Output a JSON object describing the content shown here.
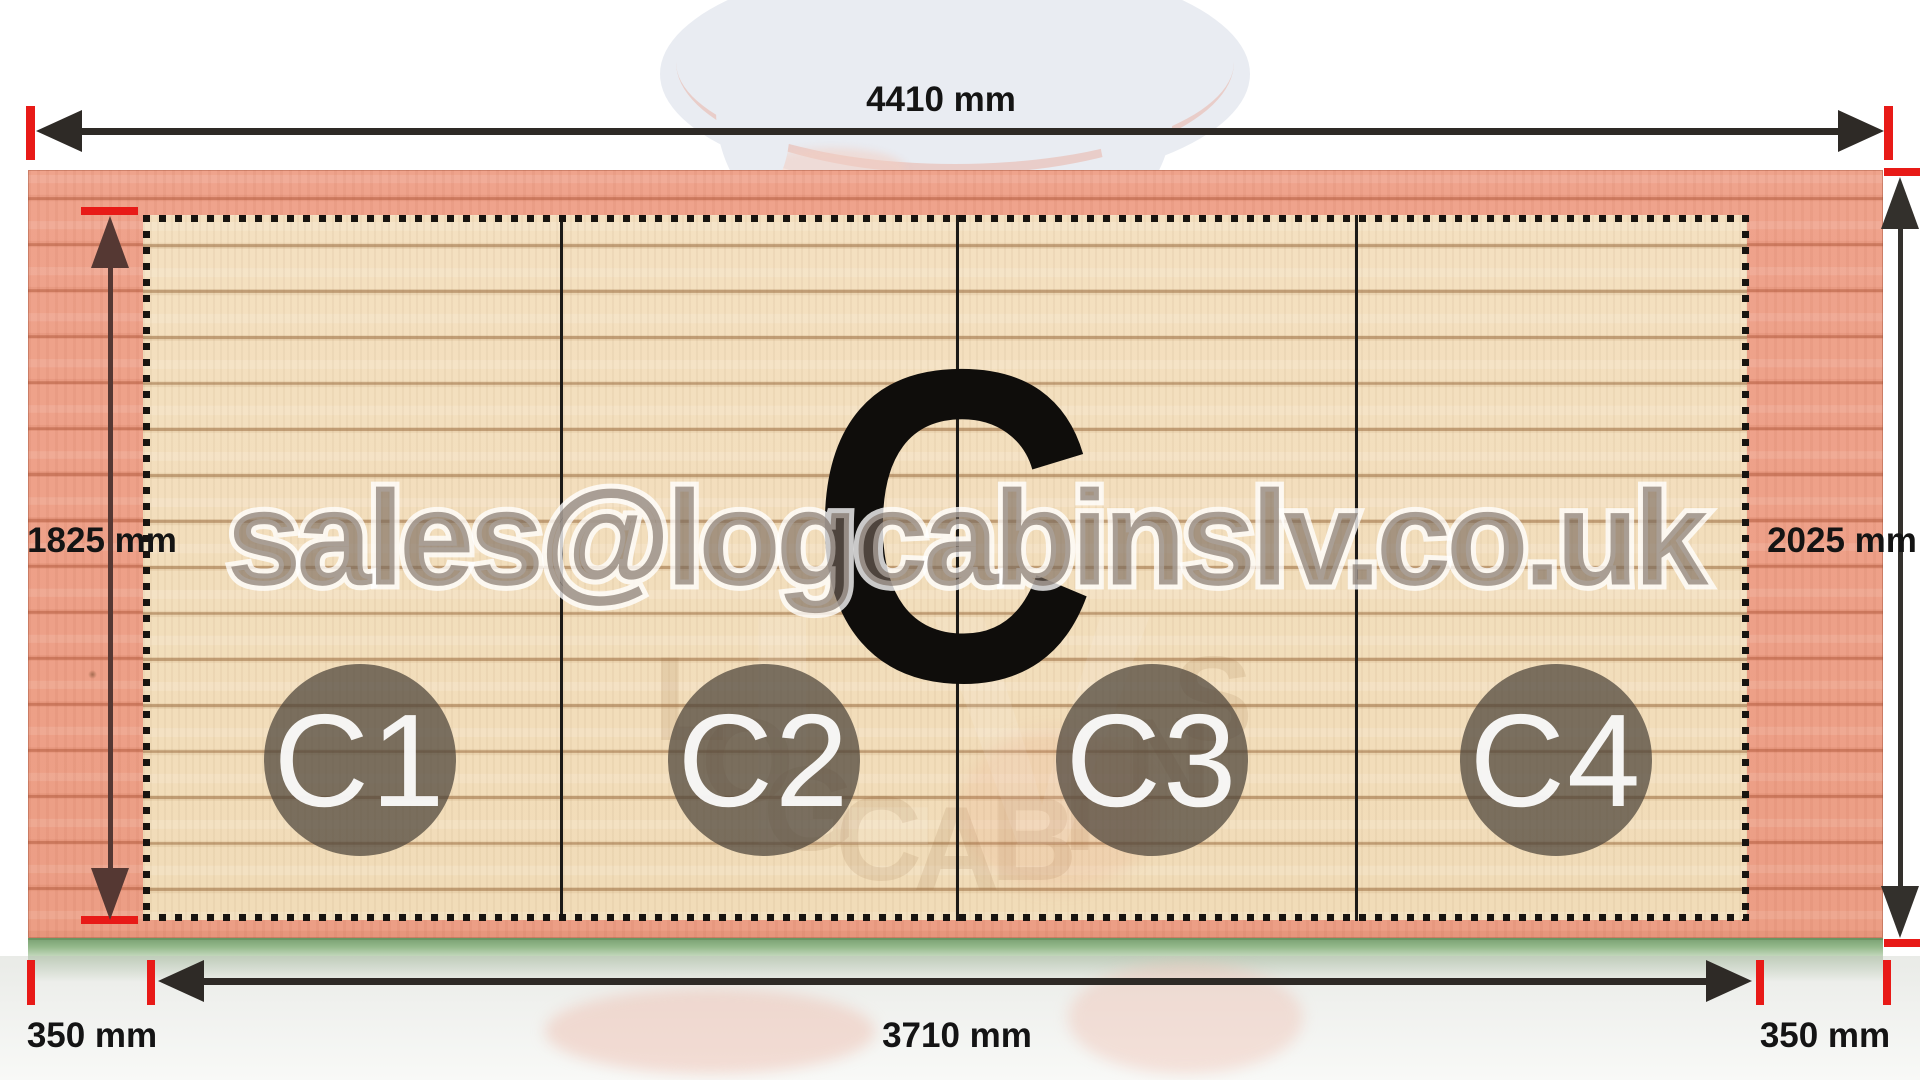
{
  "diagram": {
    "panel_label": "C",
    "sections": [
      "C1",
      "C2",
      "C3",
      "C4"
    ],
    "dims": {
      "top": "4410 mm",
      "left": "1825 mm",
      "right": "2025 mm",
      "bottom": "3710 mm",
      "bottom_left": "350 mm",
      "bottom_right": "350 mm"
    }
  },
  "watermark": {
    "email": "sales@logcabinslv.co.uk",
    "arc_text": "LOGCABINS",
    "ghost": "LV"
  },
  "colors": {
    "salmon_wood": "#efa38c",
    "inner_wood": "#f2debc",
    "foundation_green": "#93b78b",
    "tick_red": "#e81a17",
    "arrow_dark": "#2e2a26",
    "arrow_maroon": "#553833",
    "circle_fill": "rgba(75,66,57,0.72)"
  }
}
